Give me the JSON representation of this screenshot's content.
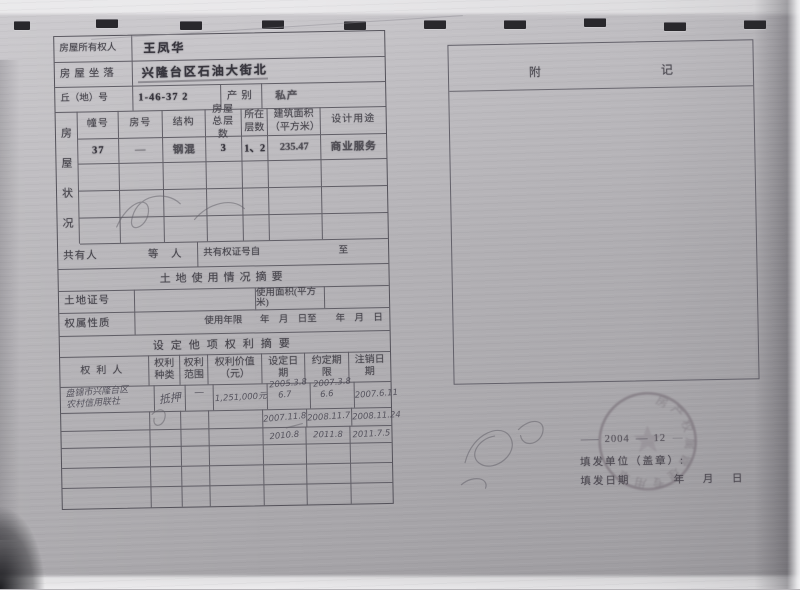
{
  "header": {
    "owner_label": "房屋所有权人",
    "owner_value": "王凤华",
    "location_label": "房屋坐落",
    "location_value": "兴隆台区石油大街北",
    "plot_label": "丘（地）号",
    "plot_value": "1-46-37 2",
    "class_label": "产别",
    "class_value": "私产"
  },
  "condition": {
    "side_chars": [
      "房",
      "屋",
      "状",
      "况"
    ],
    "headers": [
      "幢号",
      "房号",
      "结构",
      "房屋总层数",
      "所在层数",
      "建筑面积（平方米）",
      "设计用途"
    ],
    "row": [
      "37",
      "—",
      "钢混",
      "3",
      "1、2",
      "235.47",
      "商业服务"
    ]
  },
  "coowner": {
    "label": "共有人",
    "count_suffix": "等　人",
    "cert_label": "共有权证号自",
    "to_label": "至"
  },
  "land": {
    "title": "土地使用情况摘要",
    "cert_label": "土地证号",
    "area_label": "使用面积(平方米)",
    "nature_label": "权属性质",
    "years_label": "使用年限",
    "range_text": "年 月 日至　 年 月 日"
  },
  "rights": {
    "title": "设定他项权利摘要",
    "headers": [
      "权利人",
      "权利种类",
      "权利范围",
      "权利价值（元）",
      "设定日期",
      "约定期限",
      "注销日期"
    ],
    "rows": [
      {
        "holder_line1": "盘锦市兴隆台区",
        "holder_line2": "农村信用联社",
        "kind": "抵押",
        "scope": "—",
        "value": "1,251,000元",
        "set_line1": "2005.3.8",
        "set_line2": "6.7",
        "term_line1": "2007.3.8",
        "term_line2": "6.6",
        "cancel": "2007.6.11"
      },
      {
        "set": "2007.11.8",
        "term": "2008.11.7",
        "cancel": "2008.11.24"
      },
      {
        "set": "2010.8",
        "term": "2011.8",
        "cancel": "2011.7.5"
      }
    ]
  },
  "notes": {
    "title_char1": "附",
    "title_char2": "记"
  },
  "footer": {
    "issuer_label": "填发单位（盖章）:",
    "issue_date_label": "填发日期",
    "ymd": "年 月 日",
    "seal_year": "2004",
    "seal_month": "12",
    "seal_arc": "房产权属管理专用章"
  }
}
